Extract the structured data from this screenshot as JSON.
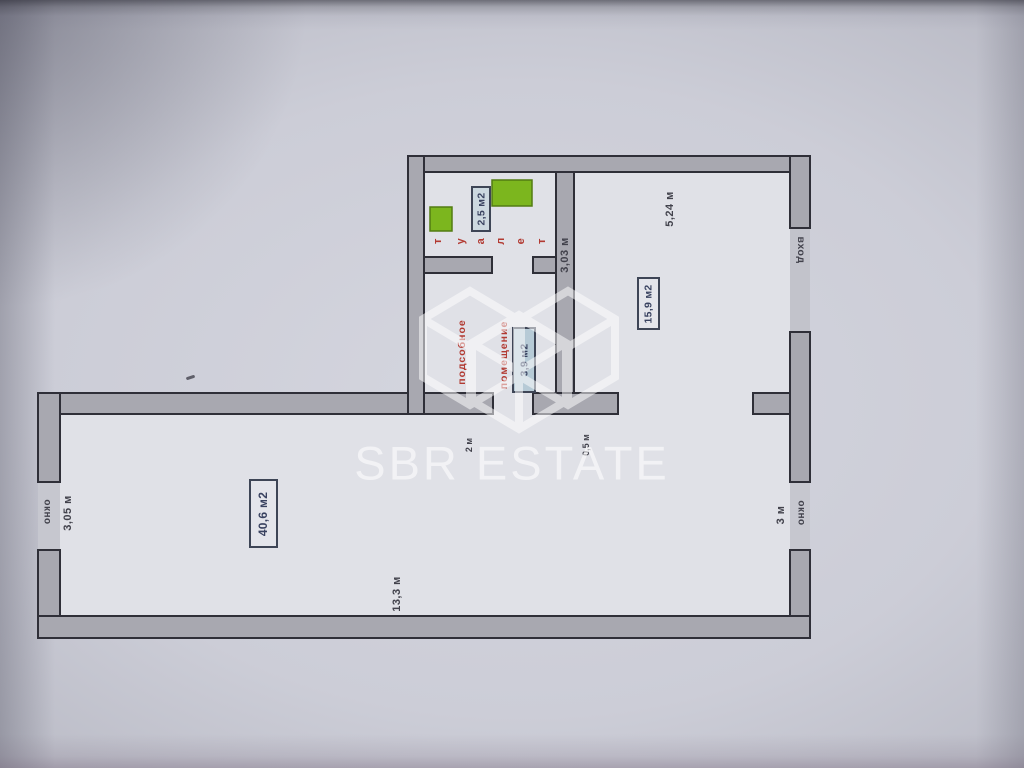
{
  "brand": {
    "watermark_text": "SBR ESTATE"
  },
  "colors": {
    "fixture_green": "#7cb61e",
    "label_red": "#b23a32",
    "area_box_blue": "#b6cad6",
    "wall_gray": "#a8a8b0",
    "floor": "#e0e1e7",
    "ink": "#42424c",
    "watermark_white": "#ffffff"
  },
  "plan": {
    "toilet": {
      "letters": [
        "т",
        "у",
        "а",
        "л",
        "е",
        "т"
      ],
      "area": "2,5 м2"
    },
    "utility": {
      "name_line1": "подсобное",
      "name_line2": "помещение",
      "area": "3,9 м2"
    },
    "hall": {
      "area": "15,9 м2",
      "top_dim": "5,24 м",
      "side_dim": "3,03 м",
      "entrance_label": "вход",
      "door_dim": "0,5 м"
    },
    "main_room": {
      "area": "40,6 м2",
      "left_dim": "3,05 м",
      "bottom_dim": "13,3 м",
      "right_dim": "3 м",
      "opening_dim": "2 м",
      "left_window_label": "окно",
      "right_window_label": "окно"
    }
  }
}
